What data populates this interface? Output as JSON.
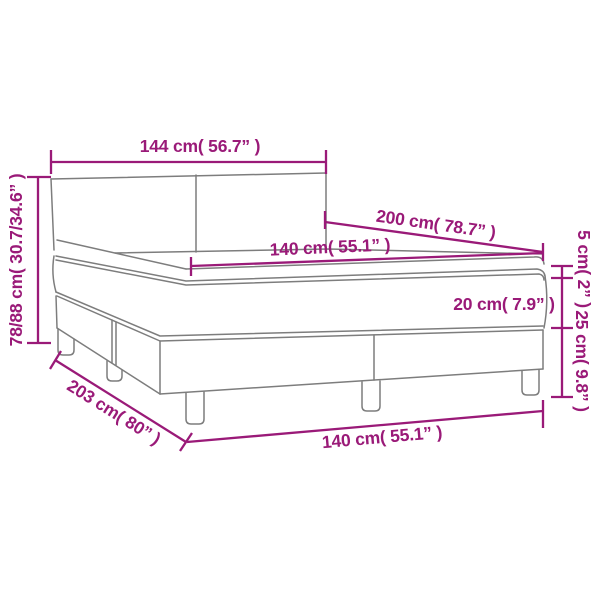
{
  "diagram": {
    "title": "box-spring-bed-dimension-diagram",
    "colors": {
      "dimension_color": "#9a1a78",
      "outline_color": "#7d7d7d",
      "background": "#ffffff"
    },
    "dimensions": {
      "headboard_width": "144 cm( 56.7” )",
      "total_height": "78/88 cm( 30.7/34.6” )",
      "bed_length": "200 cm( 78.7” )",
      "mattress_width": "140 cm( 55.1” )",
      "topper_height": "5 cm( 2” )",
      "mattress_height": "20 cm( 7.9” )",
      "base_height": "25 cm( 9.8” )",
      "frame_length": "203 cm( 80” )",
      "frame_width": "140 cm( 55.1” )"
    }
  }
}
